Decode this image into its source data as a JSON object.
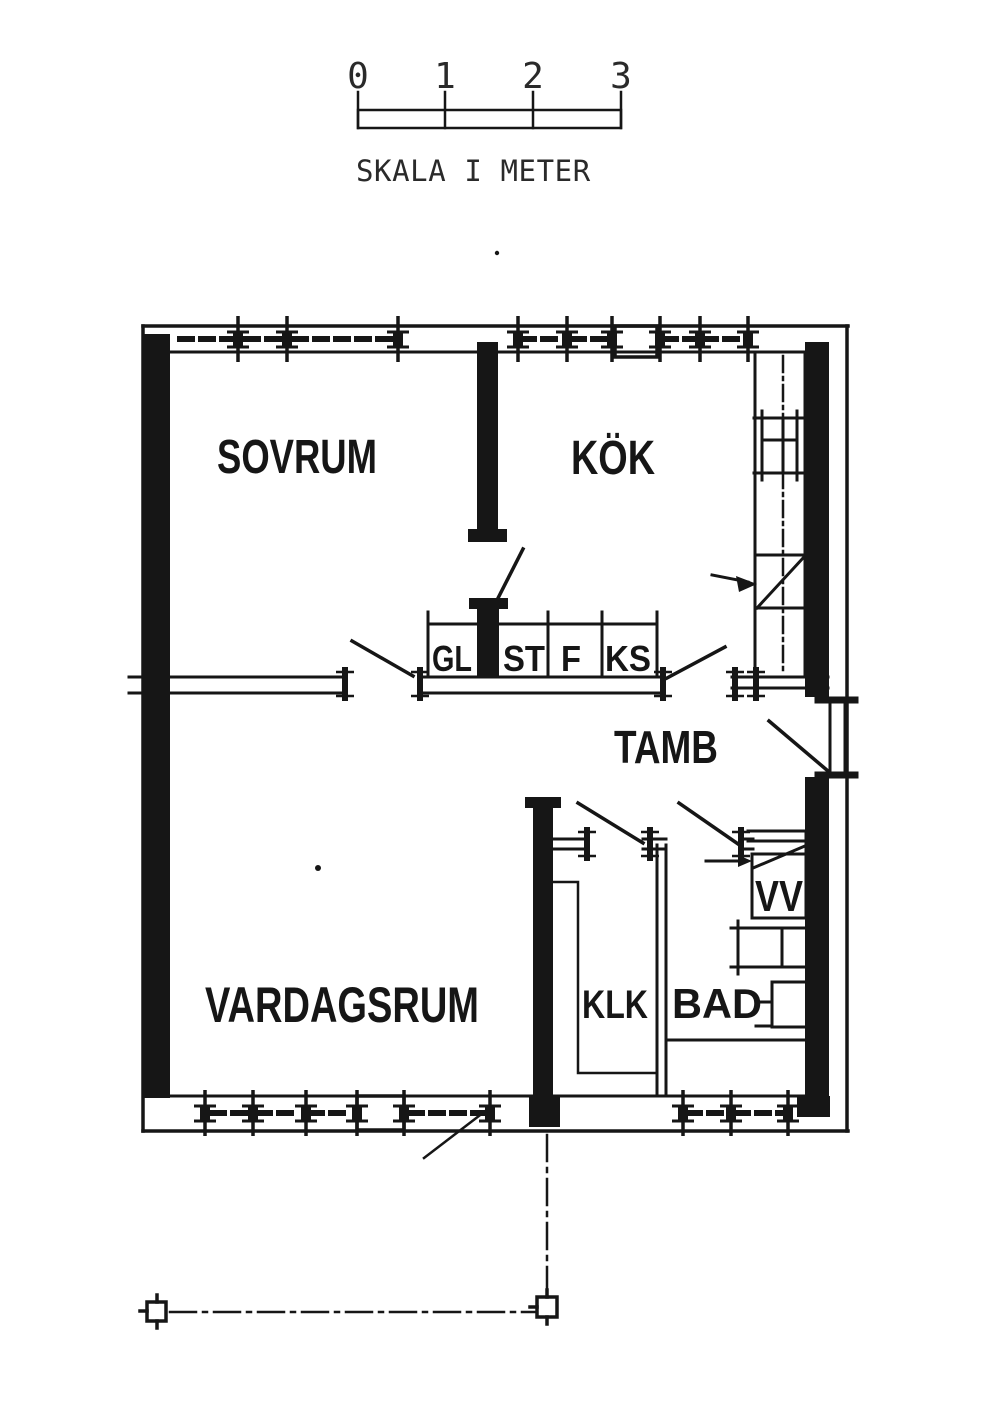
{
  "drawing": {
    "type": "floor-plan",
    "ink_color": "#161616",
    "background_color": "#ffffff"
  },
  "scale_bar": {
    "tick_labels": [
      "0",
      "1",
      "2",
      "3"
    ],
    "caption": "SKALA I METER"
  },
  "rooms": {
    "sovrum": "SOVRUM",
    "kok": "KÖK",
    "tamb": "TAMB",
    "vardagsrum": "VARDAGSRUM",
    "klk": "KLK",
    "bad": "BAD"
  },
  "fixtures": {
    "vv": "VV"
  },
  "cabinets": {
    "gl": "GL",
    "st": "ST",
    "f": "F",
    "ks": "KS"
  }
}
